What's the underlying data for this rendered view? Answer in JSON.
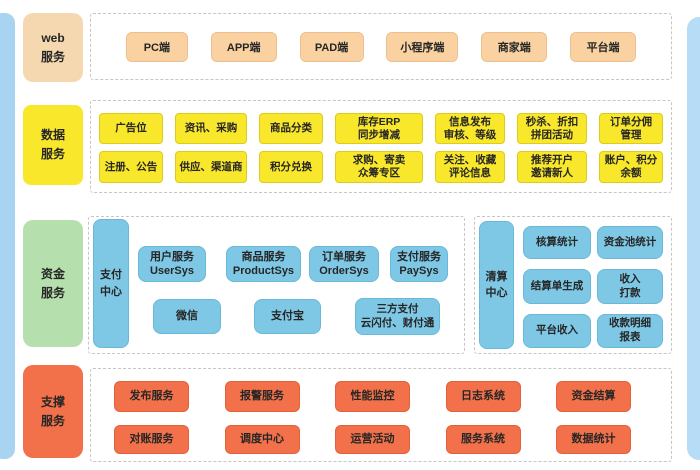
{
  "colors": {
    "side_strip_blue": "#a8d4f2",
    "web_peach": "#fad2a2",
    "web_label_peach": "#f6d8b0",
    "data_yellow": "#f8e72b",
    "fund_label_green": "#b6dfae",
    "fund_node_blue": "#7ec8e5",
    "support_orange": "#f2714a",
    "panel_dashed_border": "#c6c6c6",
    "text": "#262626"
  },
  "sections": {
    "web": {
      "label": "web\n服务",
      "items": [
        "PC端",
        "APP端",
        "PAD端",
        "小程序端",
        "商家端",
        "平台端"
      ]
    },
    "data": {
      "label": "数据\n服务",
      "row1": [
        "广告位",
        "资讯、采购",
        "商品分类",
        "库存ERP\n同步增减",
        "信息发布\n审核、等级",
        "秒杀、折扣\n拼团活动",
        "订单分佣\n管理"
      ],
      "row2": [
        "注册、公告",
        "供应、渠道商",
        "积分兑换",
        "求购、寄卖\n众筹专区",
        "关注、收藏\n评论信息",
        "推荐开户\n邀请新人",
        "账户、积分\n余额"
      ]
    },
    "fund": {
      "label": "资金\n服务",
      "pay_center": "支付\n中心",
      "pay_services": [
        "用户服务\nUserSys",
        "商品服务\nProductSys",
        "订单服务\nOrderSys",
        "支付服务\nPaySys"
      ],
      "pay_channels": [
        "微信",
        "支付宝",
        "三方支付\n云闪付、财付通"
      ],
      "clear_center": "清算\n中心",
      "clear_items": [
        "核算统计",
        "资金池统计",
        "结算单生成",
        "收入\n打款",
        "平台收入",
        "收款明细\n报表"
      ]
    },
    "support": {
      "label": "支撑\n服务",
      "row1": [
        "发布服务",
        "报警服务",
        "性能监控",
        "日志系统",
        "资金结算"
      ],
      "row2": [
        "对账服务",
        "调度中心",
        "运营活动",
        "服务系统",
        "数据统计"
      ]
    }
  }
}
